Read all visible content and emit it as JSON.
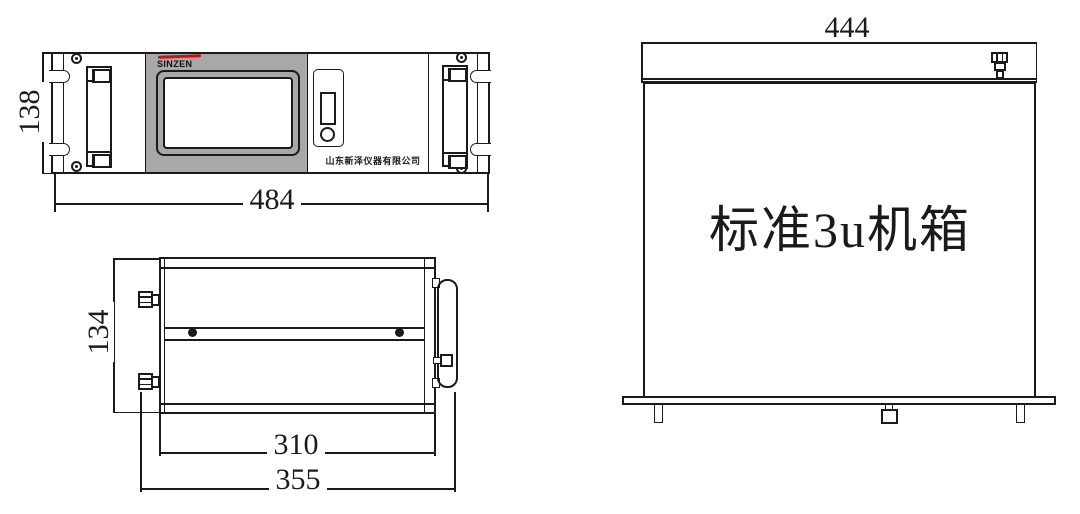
{
  "drawing": {
    "colors": {
      "line": "#1a1a1a",
      "panel_gray": "#a8a8a8",
      "accent_red": "#cc1111"
    },
    "front_view": {
      "brand": "SINZEN",
      "company": "山东新泽仪器有限公司",
      "dim_height": "138",
      "dim_width": "484"
    },
    "side_view": {
      "dim_height": "134",
      "dim_body_width": "310",
      "dim_overall_width": "355"
    },
    "rear_view": {
      "dim_width": "444",
      "label": "标准3u机箱"
    }
  }
}
